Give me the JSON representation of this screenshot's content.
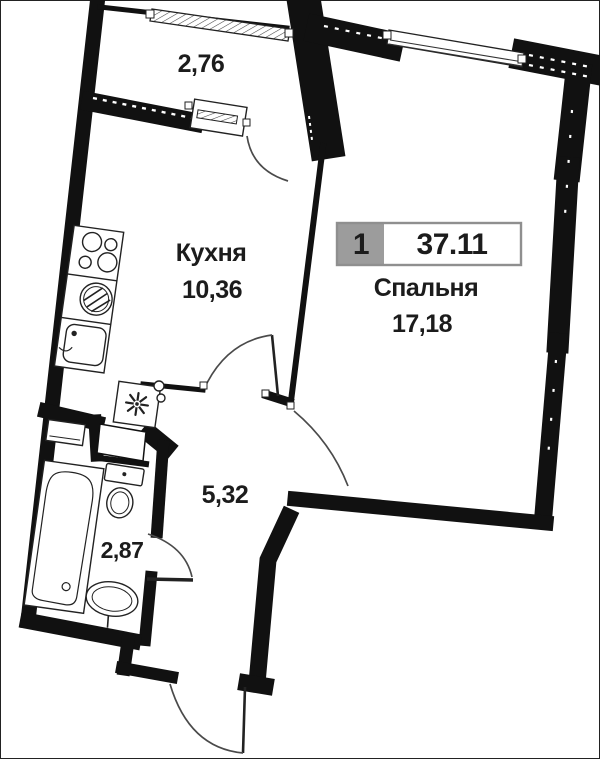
{
  "meta": {
    "kind": "apartment-floor-plan"
  },
  "badge": {
    "unit_number": "1",
    "total_area": "37.11"
  },
  "rooms": {
    "balcony": {
      "area": "2,76"
    },
    "kitchen": {
      "name": "Кухня",
      "area": "10,36"
    },
    "bedroom": {
      "name": "Спальня",
      "area": "17,18"
    },
    "hallway": {
      "area": "5,32"
    },
    "bathroom": {
      "area": "2,87"
    }
  },
  "fixtures": [
    "stove",
    "washing-machine",
    "kitchen-sink",
    "vent-shaft",
    "cabinet",
    "bathtub",
    "toilet",
    "washbasin"
  ],
  "windows": [
    "balcony-window",
    "bedroom-window"
  ],
  "doors": [
    "balcony-door",
    "kitchen-door",
    "bedroom-door",
    "bathroom-door",
    "entrance-door"
  ],
  "colors": {
    "walls": "#111111",
    "background": "#ffffff",
    "badge_fill": "#9c9c9c",
    "badge_border": "#8f8f8f",
    "label_text": "#1c1c1c",
    "door_arc": "#4a4a4a",
    "fixture_line": "#222222"
  }
}
